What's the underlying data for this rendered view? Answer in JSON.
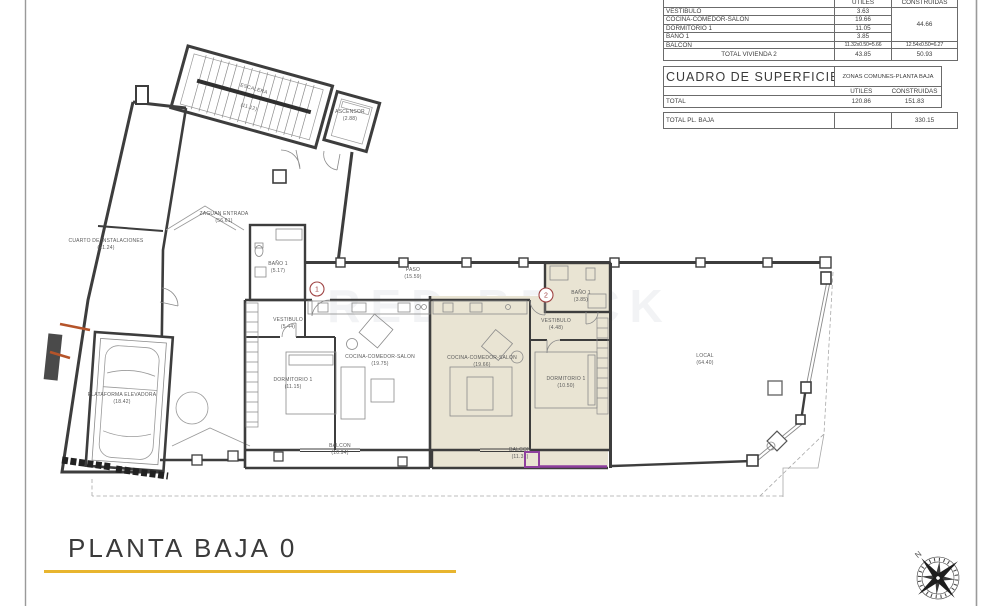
{
  "tables": {
    "vivienda2": {
      "headers": {
        "utiles": "UTILES",
        "construidas": "CONSTRUIDAS"
      },
      "rows": [
        {
          "label": "VESTIBULO",
          "utiles": "3.63"
        },
        {
          "label": "COCINA-COMEDOR-SALON",
          "utiles": "19.66"
        },
        {
          "label": "DORMITORIO 1",
          "utiles": "11.05"
        },
        {
          "label": "BAÑO 1",
          "utiles": "3.85"
        }
      ],
      "construidas_total": "44.66",
      "balcon": {
        "label": "BALCON",
        "utiles": "11.32x0.50=5.66",
        "construidas": "12.54x0.50=6.27"
      },
      "total": {
        "label": "TOTAL VIVIENDA 2",
        "utiles": "43.85",
        "construidas": "50.93"
      }
    },
    "superficies": {
      "title": "CUADRO DE SUPERFICIES",
      "subtitle": "ZONAS COMUNES-PLANTA BAJA",
      "headers": {
        "utiles": "UTILES",
        "construidas": "CONSTRUIDAS"
      },
      "total": {
        "label": "TOTAL",
        "utiles": "120.86",
        "construidas": "151.83"
      }
    },
    "total_planta": {
      "label": "TOTAL PL. BAJA",
      "construidas": "330.15"
    }
  },
  "plan": {
    "rooms": {
      "escalera": {
        "name": "ESCALERA",
        "area": "(11.12)"
      },
      "ascensor": {
        "name": "ASCENSOR",
        "area": "(2.88)"
      },
      "cuarto_inst": {
        "name": "CUARTO DE INSTALACIONES",
        "area": "(21.24)"
      },
      "plataforma": {
        "name": "PLATAFORMA ELEVADORA",
        "area": "(18.42)"
      },
      "zaguan": {
        "name": "ZAGUAN ENTRADA",
        "area": "(56.61)"
      },
      "bano_v1": {
        "name": "BAÑO 1",
        "area": "(5.17)"
      },
      "paso": {
        "name": "PASO",
        "area": "(15.59)"
      },
      "vestibulo_v1": {
        "name": "VESTIBULO",
        "area": "(5.44)"
      },
      "dormitorio_v1": {
        "name": "DORMITORIO 1",
        "area": "(11.15)"
      },
      "cocina_v1": {
        "name": "COCINA-COMEDOR-SALON",
        "area": "(19.75)"
      },
      "balcon_v1": {
        "name": "BALCON",
        "area": "(10.94)"
      },
      "bano_v2": {
        "name": "BAÑO 1",
        "area": "(3.85)"
      },
      "vestibulo_v2": {
        "name": "VESTIBULO",
        "area": "(4.48)"
      },
      "dormitorio_v2": {
        "name": "DORMITORIO 1",
        "area": "(10.50)"
      },
      "cocina_v2": {
        "name": "COCINA-COMEDOR-SALON",
        "area": "(19.66)"
      },
      "balcon_v2": {
        "name": "BALCON",
        "area": "(11.32)"
      },
      "local": {
        "name": "LOCAL",
        "area": "(64.40)"
      }
    },
    "markers": {
      "unit1": "1",
      "unit2": "2"
    },
    "watermark": "RED BRICK",
    "colors": {
      "highlight": "#e9e4d3",
      "purple": "#8e3f9e",
      "orange": "#b5542a",
      "accent_yellow": "#e8b52f",
      "marker_red": "#a04545"
    }
  },
  "compass": {
    "north": "N"
  },
  "footer": {
    "title": "PLANTA BAJA 0"
  }
}
